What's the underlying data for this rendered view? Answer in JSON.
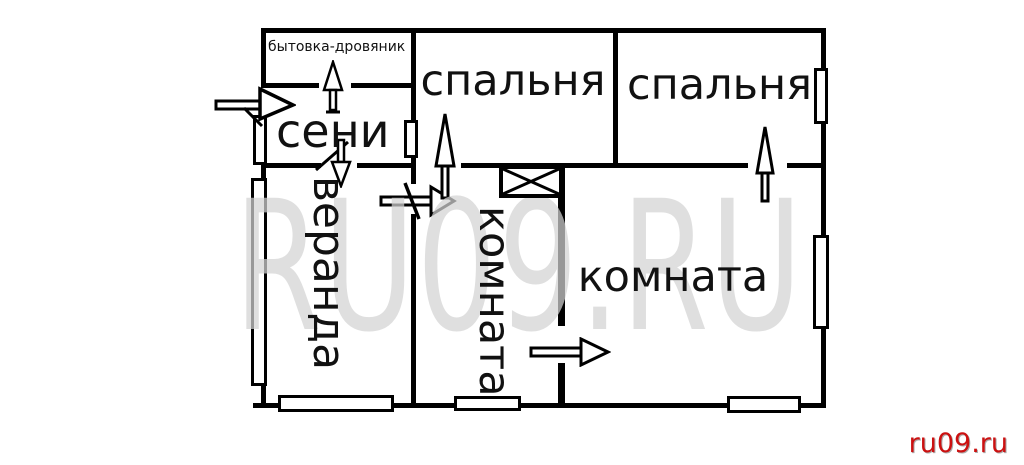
{
  "labels": {
    "bytovka": "бытовка-дровяник",
    "seni": "сени",
    "spalnya_left": "спальня",
    "spalnya_right": "спальня",
    "veranda": "веранда",
    "komnata_vertical": "комната",
    "komnata_main": "комната"
  },
  "watermark": "RU09.RU",
  "credit": "ru09.ru",
  "colors": {
    "wall": "#000000",
    "watermark_gray": "#d2d2d2",
    "credit_red": "#cc1111"
  }
}
